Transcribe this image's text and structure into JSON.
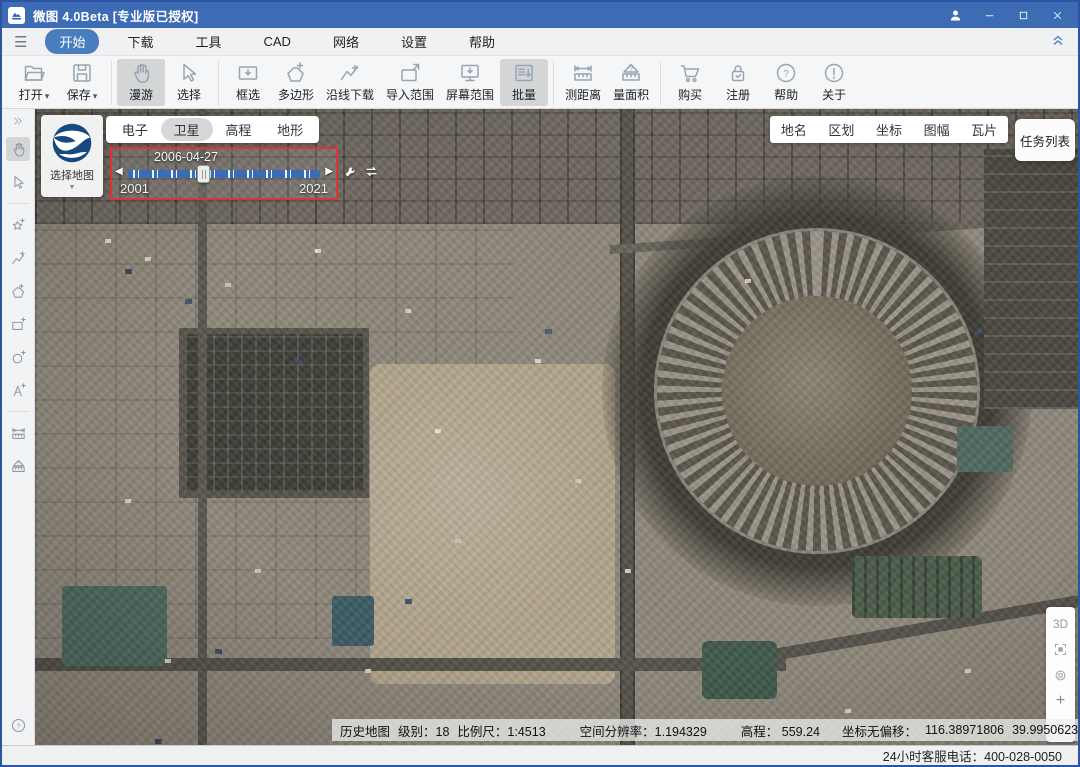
{
  "window": {
    "app_title": "微图 4.0Beta [专业版已授权]"
  },
  "menubar": {
    "items": [
      "开始",
      "下载",
      "工具",
      "CAD",
      "网络",
      "设置",
      "帮助"
    ]
  },
  "toolbar": {
    "open": "打开",
    "save": "保存",
    "roam": "漫游",
    "select": "选择",
    "box_select": "框选",
    "polygon": "多边形",
    "along_line": "沿线下载",
    "import_range": "导入范围",
    "screen_range": "屏幕范围",
    "batch": "批量",
    "measure_distance": "测距离",
    "measure_area": "量面积",
    "buy": "购买",
    "register": "注册",
    "help": "帮助",
    "about": "关于"
  },
  "map_overlay": {
    "map_picker_label": "选择地图",
    "layer_tabs": [
      "电子",
      "卫星",
      "高程",
      "地形"
    ],
    "active_layer": "卫星",
    "timeline": {
      "current_date": "2006-04-27",
      "start_year": "2001",
      "end_year": "2021"
    },
    "info_tabs": [
      "地名",
      "区划",
      "坐标",
      "图幅",
      "瓦片"
    ],
    "task_list_label": "任务列表",
    "nav": {
      "mode_3d": "3D",
      "zoom_in": "+",
      "zoom_out": "−"
    }
  },
  "statusbar": {
    "history_map": "历史地图",
    "level": "级别：18",
    "scale": "比例尺：1:4513",
    "resolution": "空间分辨率：1.194329",
    "elevation": "高程： 559.24",
    "offset_label": "坐标无偏移：",
    "longitude": "116.38971806",
    "latitude": "39.9950623"
  },
  "footer": {
    "service_phone": "24小时客服电话：400-028-0050"
  },
  "icons": {
    "dropdown": "▾",
    "caret_down": "▼",
    "skip_back": "◀",
    "skip_forward": "▶",
    "hamburger": "☰"
  },
  "colors": {
    "titlebar": "#3d6cb5",
    "accent_pill": "#4a7dbf",
    "timeline_border": "#e03232",
    "slider_track": "#3a6cb5"
  }
}
